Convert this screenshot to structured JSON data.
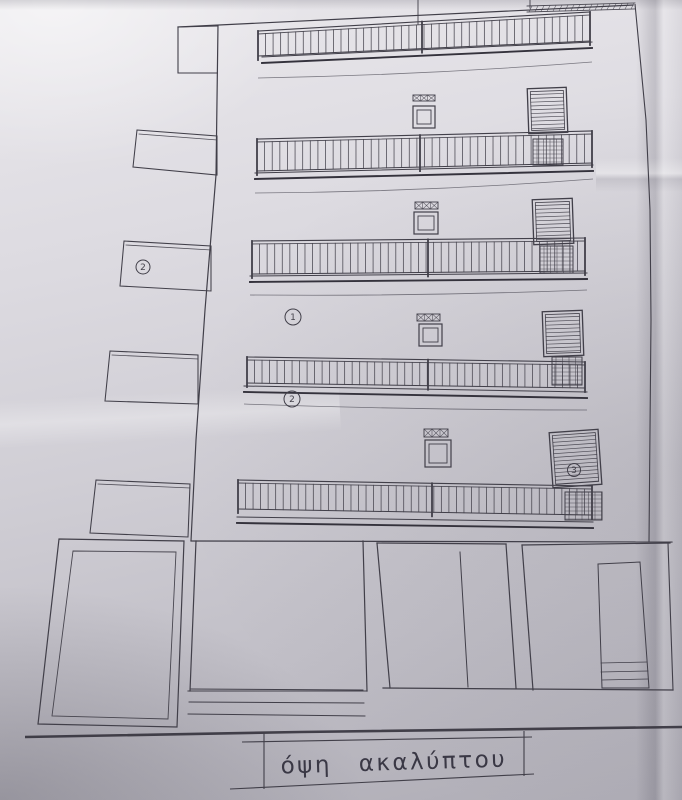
{
  "drawing": {
    "type": "architectural-elevation-scan",
    "title": "όψη ακαλύπτου",
    "line_color": "#413f49",
    "paper_color": "#d0ced5",
    "labels": [
      {
        "id": "left-balcony-floor4",
        "text": "2"
      },
      {
        "id": "facade-floor3",
        "text": "1"
      },
      {
        "id": "facade-floor2",
        "text": "2"
      },
      {
        "id": "door-floor1",
        "text": "3"
      }
    ]
  }
}
